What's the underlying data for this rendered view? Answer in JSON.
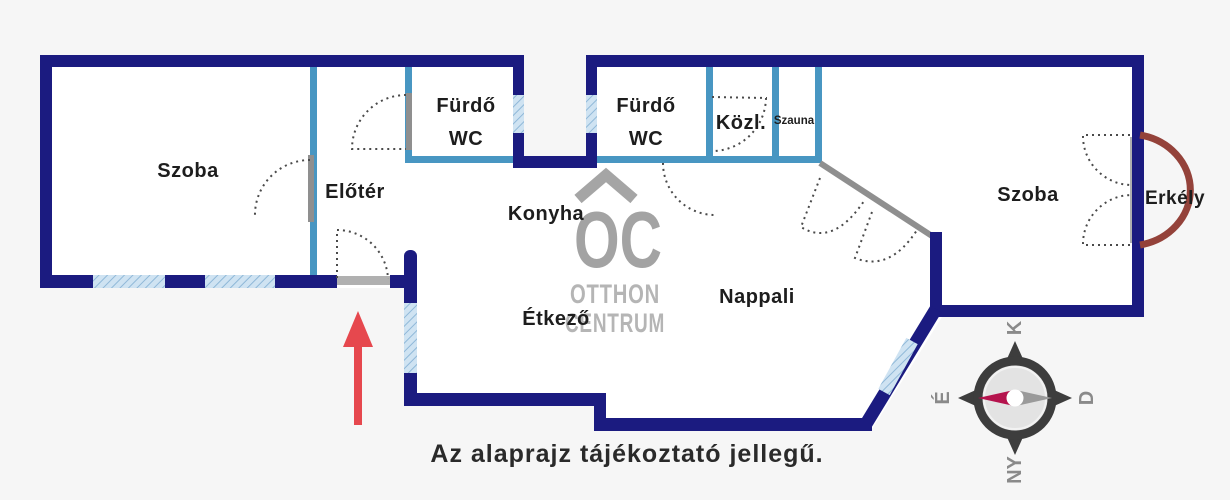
{
  "rooms": {
    "szoba_left": {
      "label": "Szoba"
    },
    "eloter": {
      "label": "Előtér"
    },
    "furdo_wc_1": {
      "line1": "Fürdő",
      "line2": "WC"
    },
    "furdo_wc_2": {
      "line1": "Fürdő",
      "line2": "WC"
    },
    "konyha": {
      "label": "Konyha"
    },
    "kozl": {
      "label": "Közl."
    },
    "szauna": {
      "label": "Szauna"
    },
    "etkezo": {
      "label": "Étkező"
    },
    "nappali": {
      "label": "Nappali"
    },
    "szoba_right": {
      "label": "Szoba"
    },
    "erkely": {
      "label": "Erkély"
    }
  },
  "disclaimer": {
    "text": "Az alaprajz tájékoztató jellegű."
  },
  "watermark": {
    "logo": "OC",
    "name_line1": "OTTHON",
    "name_line2": "CENTRUM"
  },
  "compass": {
    "top": "K",
    "right": "D",
    "bottom": "NY",
    "left": "É"
  },
  "colors": {
    "outer_wall": "#1b1b80",
    "inner_wall": "#4896c2",
    "window_fill": "#cfe3f2",
    "window_hatch": "#8fb8d8",
    "balcony_arc": "#94423a",
    "entrance_arrow": "#e6484e",
    "compass_needle_red": "#b5134d",
    "compass_needle_gray": "#9a9a9a"
  }
}
